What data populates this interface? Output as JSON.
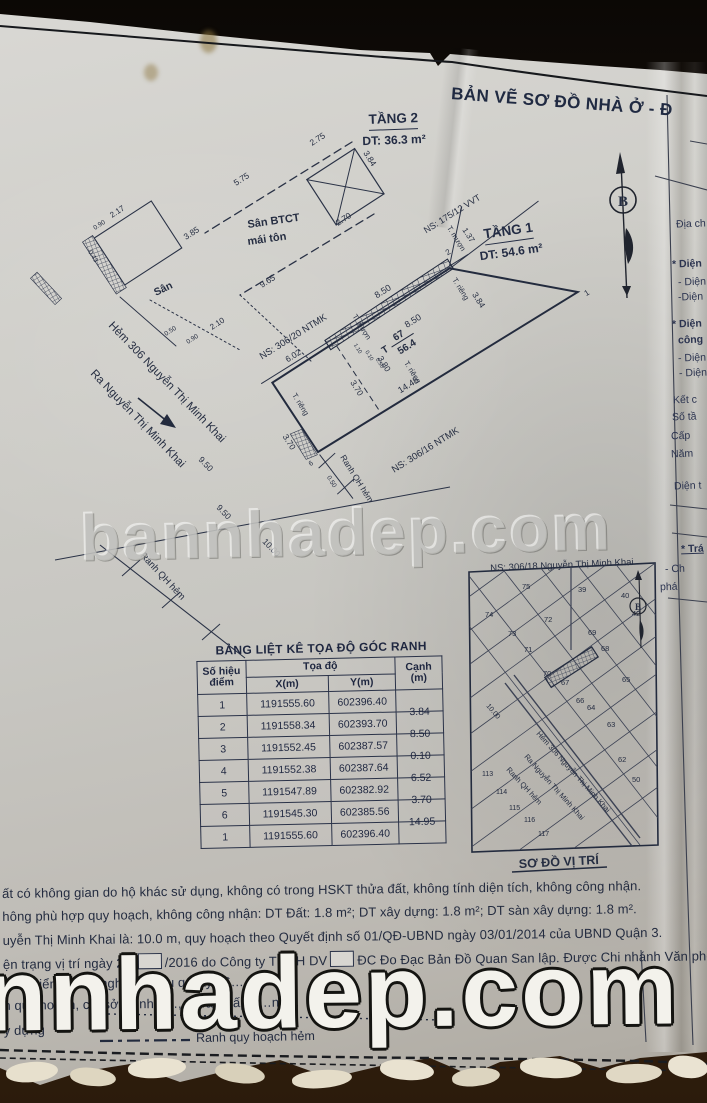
{
  "colors": {
    "ink": "#262e42",
    "title_ink": "#202a42",
    "paper": "#cbc9c4",
    "wood": "#1c120a",
    "watermark_white": "#f3f2ec"
  },
  "title": "BẢN VẼ SƠ ĐỒ NHÀ Ở - Đ",
  "north": {
    "label": "B"
  },
  "floor2": {
    "name": "TẦNG 2",
    "area": "DT: 36.3 m²",
    "san_btct_1": "Sân BTCT",
    "san_btct_2": "mái tôn",
    "san": "Sân",
    "dims": {
      "d275": "2.75",
      "d384": "3.84",
      "d270": "2.70",
      "d575": "5.75",
      "d385": "3.85",
      "d217": "2.17",
      "d090": "0.90",
      "d043": "0.43",
      "d965": "9.65",
      "d050": "0.50",
      "d090b": "0.90",
      "d210": "2.10"
    }
  },
  "floor1": {
    "name": "TẦNG 1",
    "area": "DT: 54.6 m²",
    "lot_prefix": "T",
    "lot_no": "67",
    "lot_area": "56.4",
    "walls": {
      "t_rieng_left": "T. riêng",
      "t_rieng_bottom": "T. riêng",
      "t_rieng_right": "T. riêng",
      "t_muon_wall": "T. mượn",
      "t_muon_alley": "T. mượn"
    },
    "dims": {
      "d850_top": "8.50",
      "d850_in": "8.50",
      "d380": "3.80",
      "d370_in": "3.70",
      "d370_out": "3.70",
      "d1445": "14.45",
      "d384": "3.84",
      "d137": "1.37",
      "d602": "6.02",
      "d110": "1.10",
      "d010": "0.10",
      "d050_top": "0.50",
      "d050_corner": "0.50",
      "d950_a": "9.50",
      "d950_b": "9.50",
      "d1000": "10.00"
    },
    "points": {
      "p1": "1",
      "p2": "2",
      "p6": "6"
    },
    "neighbors": {
      "ns_306_20": "NS: 306/20 NTMK",
      "ns_306_16": "NS: 306/16 NTMK",
      "ns_175_12": "NS: 175/12 VVT"
    },
    "streets": {
      "hem_306": "Hẻm 306 Nguyễn Thị Minh Khai",
      "ra_street": "Ra Nguyễn Thị Minh Khai"
    },
    "boundaries": {
      "ranh_a": "Ranh QH hẻm",
      "ranh_b": "Ranh QH hẻm"
    }
  },
  "table": {
    "title": "BẢNG LIỆT KÊ TỌA ĐỘ GÓC RANH",
    "col_point_1": "Số hiệu",
    "col_point_2": "điểm",
    "col_coords": "Tọa độ",
    "col_x": "X(m)",
    "col_y": "Y(m)",
    "col_edge_1": "Cạnh",
    "col_edge_2": "(m)",
    "rows": [
      {
        "pt": "1",
        "x": "1191555.60",
        "y": "602396.40",
        "edge": ""
      },
      {
        "pt": "2",
        "x": "1191558.34",
        "y": "602393.70",
        "edge": "3.84"
      },
      {
        "pt": "3",
        "x": "1191552.45",
        "y": "602387.57",
        "edge": "8.50"
      },
      {
        "pt": "4",
        "x": "1191552.38",
        "y": "602387.64",
        "edge": "0.10"
      },
      {
        "pt": "5",
        "x": "1191547.89",
        "y": "602382.92",
        "edge": "6.52"
      },
      {
        "pt": "6",
        "x": "1191545.30",
        "y": "602385.56",
        "edge": "3.70"
      },
      {
        "pt": "1",
        "x": "1191555.60",
        "y": "602396.40",
        "edge": "14.95"
      }
    ]
  },
  "map": {
    "header": "NS: 306/18 Nguyễn Thị Minh Khai",
    "caption": "SƠ ĐỒ VỊ TRÍ",
    "north_label": "B",
    "dim_1000": "10.00",
    "ranh": "Ranh QH hẻm",
    "hem_306": "Hẻm 306 Nguyễn Thị Minh Khai",
    "ra_street": "Ra Nguyễn Thị Minh Khai",
    "lots": {
      "l39": "39",
      "l40": "40",
      "l42": "42",
      "l50": "50",
      "l62": "62",
      "l63": "63",
      "l64": "64",
      "l65": "65",
      "l66": "66",
      "l67": "67",
      "l68": "68",
      "l69": "69",
      "l70": "70",
      "l71": "71",
      "l72": "72",
      "l73": "73",
      "l74": "74",
      "l75": "75",
      "l113": "113",
      "l114": "114",
      "l115": "115",
      "l116": "116",
      "l117": "117"
    }
  },
  "side_panel": {
    "lines": [
      "Địa ch",
      "* Diện",
      "- Diện",
      "-Diện",
      "* Diện",
      "công",
      "- Diện",
      "- Diện",
      "Kết c",
      "Số tầ",
      "Cấp",
      "Năm",
      "Diện t",
      "* Trá",
      "- Ch",
      "phá"
    ]
  },
  "notes": {
    "line1": "ất có không gian do hộ khác sử dụng, không có trong HSKT thửa đất, không tính diện tích, không công nhận.",
    "line2": "hông phù hợp quy hoạch, không công nhận: DT Đất: 1.8 m²; DT xây dựng: 1.8 m²; DT sàn xây dựng: 1.8 m².",
    "line3": "uyễn Thị Minh Khai là: 10.0 m, quy hoạch theo Quyết định số 01/QĐ-UBND ngày 03/01/2014 của UBND Quận 3.",
    "line4a": "ện trạng vị trí ngày 22/",
    "line4b": "/2016 do Công ty TNHH DV",
    "line4c": "ĐC Đo Đạc Bản Đồ Quan San lập. Được Chi nhánh Văn phòng",
    "line5": "ân 3 kiểm tra … nghiệ…  điều q…ày 26…",
    "line6": "n quy hoạch, chỉ sở … nhà …, đ…ải …ấp h…n t…",
    "line7": "y dựng",
    "legend_label": "Ranh quy hoạch hẻm"
  },
  "watermarks": {
    "mid": "bannhadep.com",
    "bottom": "nnhadep.com"
  }
}
